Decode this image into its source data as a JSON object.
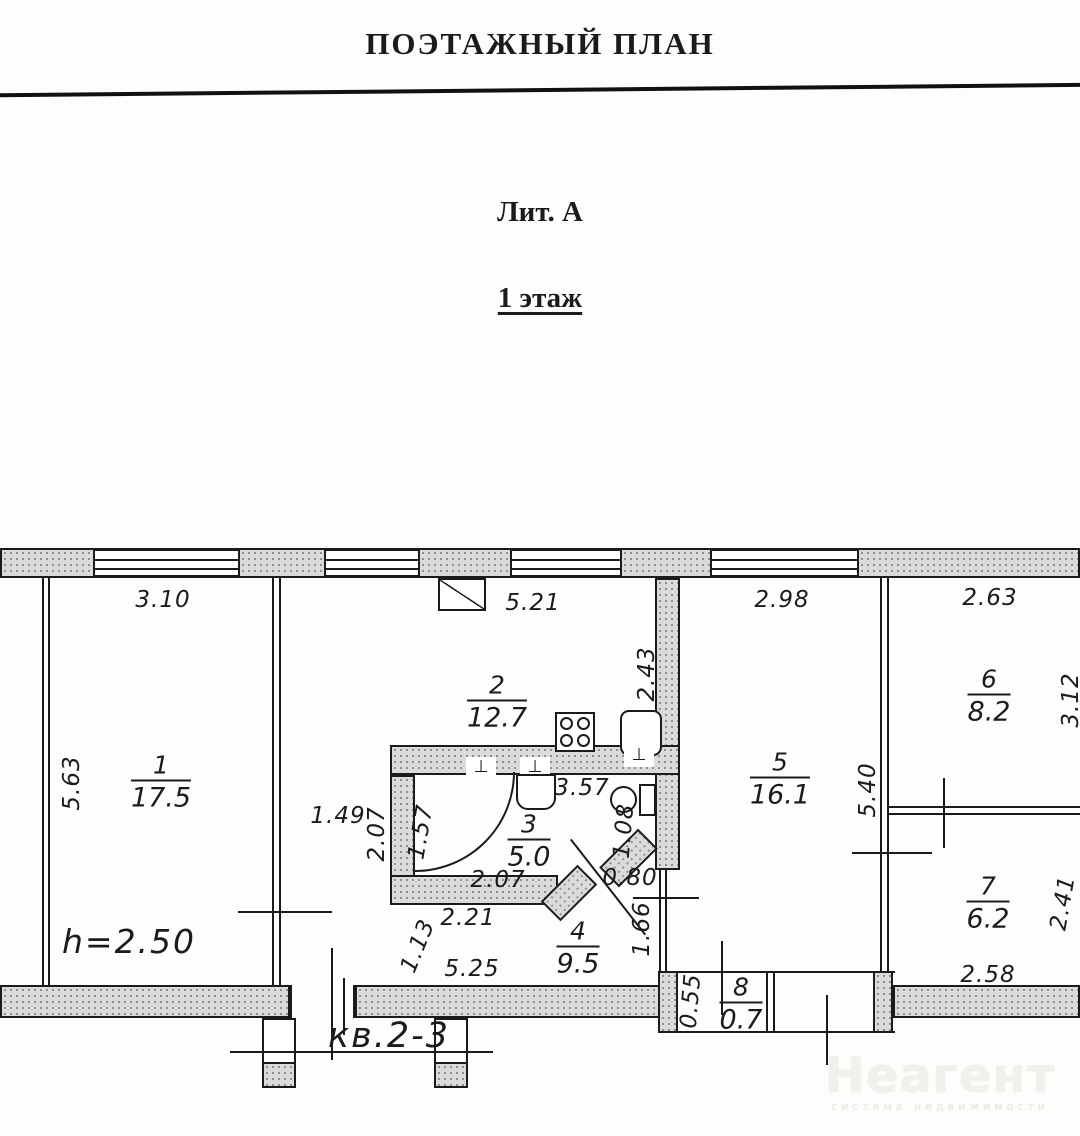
{
  "header": {
    "title": "ПОЭТАЖНЫЙ ПЛАН",
    "liter": "Лит. А",
    "floor": "1 этаж"
  },
  "plan": {
    "apartment_label": "кв.2-3",
    "ceiling_height": "h=2.50",
    "rooms": [
      {
        "number": "1",
        "area": "17.5",
        "x": 161,
        "y": 782
      },
      {
        "number": "2",
        "area": "12.7",
        "x": 497,
        "y": 702
      },
      {
        "number": "3",
        "area": "5.0",
        "x": 529,
        "y": 841
      },
      {
        "number": "4",
        "area": "9.5",
        "x": 578,
        "y": 948
      },
      {
        "number": "5",
        "area": "16.1",
        "x": 780,
        "y": 779
      },
      {
        "number": "6",
        "area": "8.2",
        "x": 989,
        "y": 696
      },
      {
        "number": "7",
        "area": "6.2",
        "x": 988,
        "y": 903
      },
      {
        "number": "8",
        "area": "0.7",
        "x": 741,
        "y": 1004
      }
    ],
    "dimensions": [
      {
        "text": "3.10",
        "x": 163,
        "y": 600,
        "rot": 0
      },
      {
        "text": "5.21",
        "x": 533,
        "y": 603,
        "rot": 0
      },
      {
        "text": "2.98",
        "x": 782,
        "y": 600,
        "rot": 0
      },
      {
        "text": "2.63",
        "x": 990,
        "y": 598,
        "rot": 0
      },
      {
        "text": "5.63",
        "x": 72,
        "y": 783,
        "rot": -90
      },
      {
        "text": "2.43",
        "x": 647,
        "y": 674,
        "rot": -90
      },
      {
        "text": "5.40",
        "x": 868,
        "y": 790,
        "rot": -90
      },
      {
        "text": "3.12",
        "x": 1071,
        "y": 700,
        "rot": -90
      },
      {
        "text": "1.49",
        "x": 338,
        "y": 816,
        "rot": 0
      },
      {
        "text": "2.07",
        "x": 377,
        "y": 834,
        "rot": -90
      },
      {
        "text": "1.57",
        "x": 421,
        "y": 832,
        "rot": -80
      },
      {
        "text": "3.57",
        "x": 582,
        "y": 788,
        "rot": 0
      },
      {
        "text": "1.08",
        "x": 624,
        "y": 831,
        "rot": -85
      },
      {
        "text": "0.80",
        "x": 630,
        "y": 878,
        "rot": 0
      },
      {
        "text": "1.66",
        "x": 642,
        "y": 929,
        "rot": -90
      },
      {
        "text": "2.07",
        "x": 498,
        "y": 880,
        "rot": 0
      },
      {
        "text": "2.21",
        "x": 468,
        "y": 918,
        "rot": 0
      },
      {
        "text": "1.13",
        "x": 418,
        "y": 946,
        "rot": -68
      },
      {
        "text": "5.25",
        "x": 472,
        "y": 969,
        "rot": 0
      },
      {
        "text": "2.58",
        "x": 988,
        "y": 975,
        "rot": 0
      },
      {
        "text": "2.41",
        "x": 1063,
        "y": 903,
        "rot": -80
      },
      {
        "text": "0.55",
        "x": 691,
        "y": 1001,
        "rot": -85
      }
    ],
    "icons": {
      "vent": "box-with-diagonal",
      "stove": "square-4-burners",
      "fridge": "rounded-square",
      "bathtub": "quarter-arc",
      "sink": "rounded-bottom-square",
      "toilet": "circle-with-tank",
      "plumbing_tap": "⊥"
    }
  },
  "watermark": {
    "brand": "Неагент",
    "tagline": "система недвижимости"
  },
  "colors": {
    "line": "#1b1b1b",
    "wall_fill": "#dbdbd9",
    "paper": "#fdfdfb",
    "watermark": "#f1f0ec"
  }
}
